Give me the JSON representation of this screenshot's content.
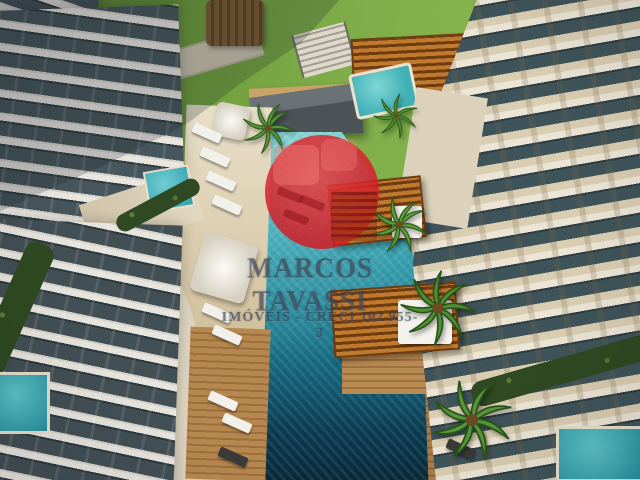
{
  "watermark": {
    "line1": "MARCOS TAVASSI",
    "line2": "IMÓVEIS - CRECI 102.955-3",
    "circle_color": "#d21a24"
  },
  "palette": {
    "pool_turquoise": "#35aab4",
    "pool_deep": "#0a3a50",
    "lawn_green": "#6f9e3b",
    "deck_wood": "#b3854f",
    "building_white": "#e9e6e0",
    "building_cream": "#d9cdb2",
    "balcony_glass": "#3f545a",
    "pergola_orange": "#c07a2e",
    "palm_green": "#4f8d32",
    "watermark_red": "#d21a24"
  }
}
